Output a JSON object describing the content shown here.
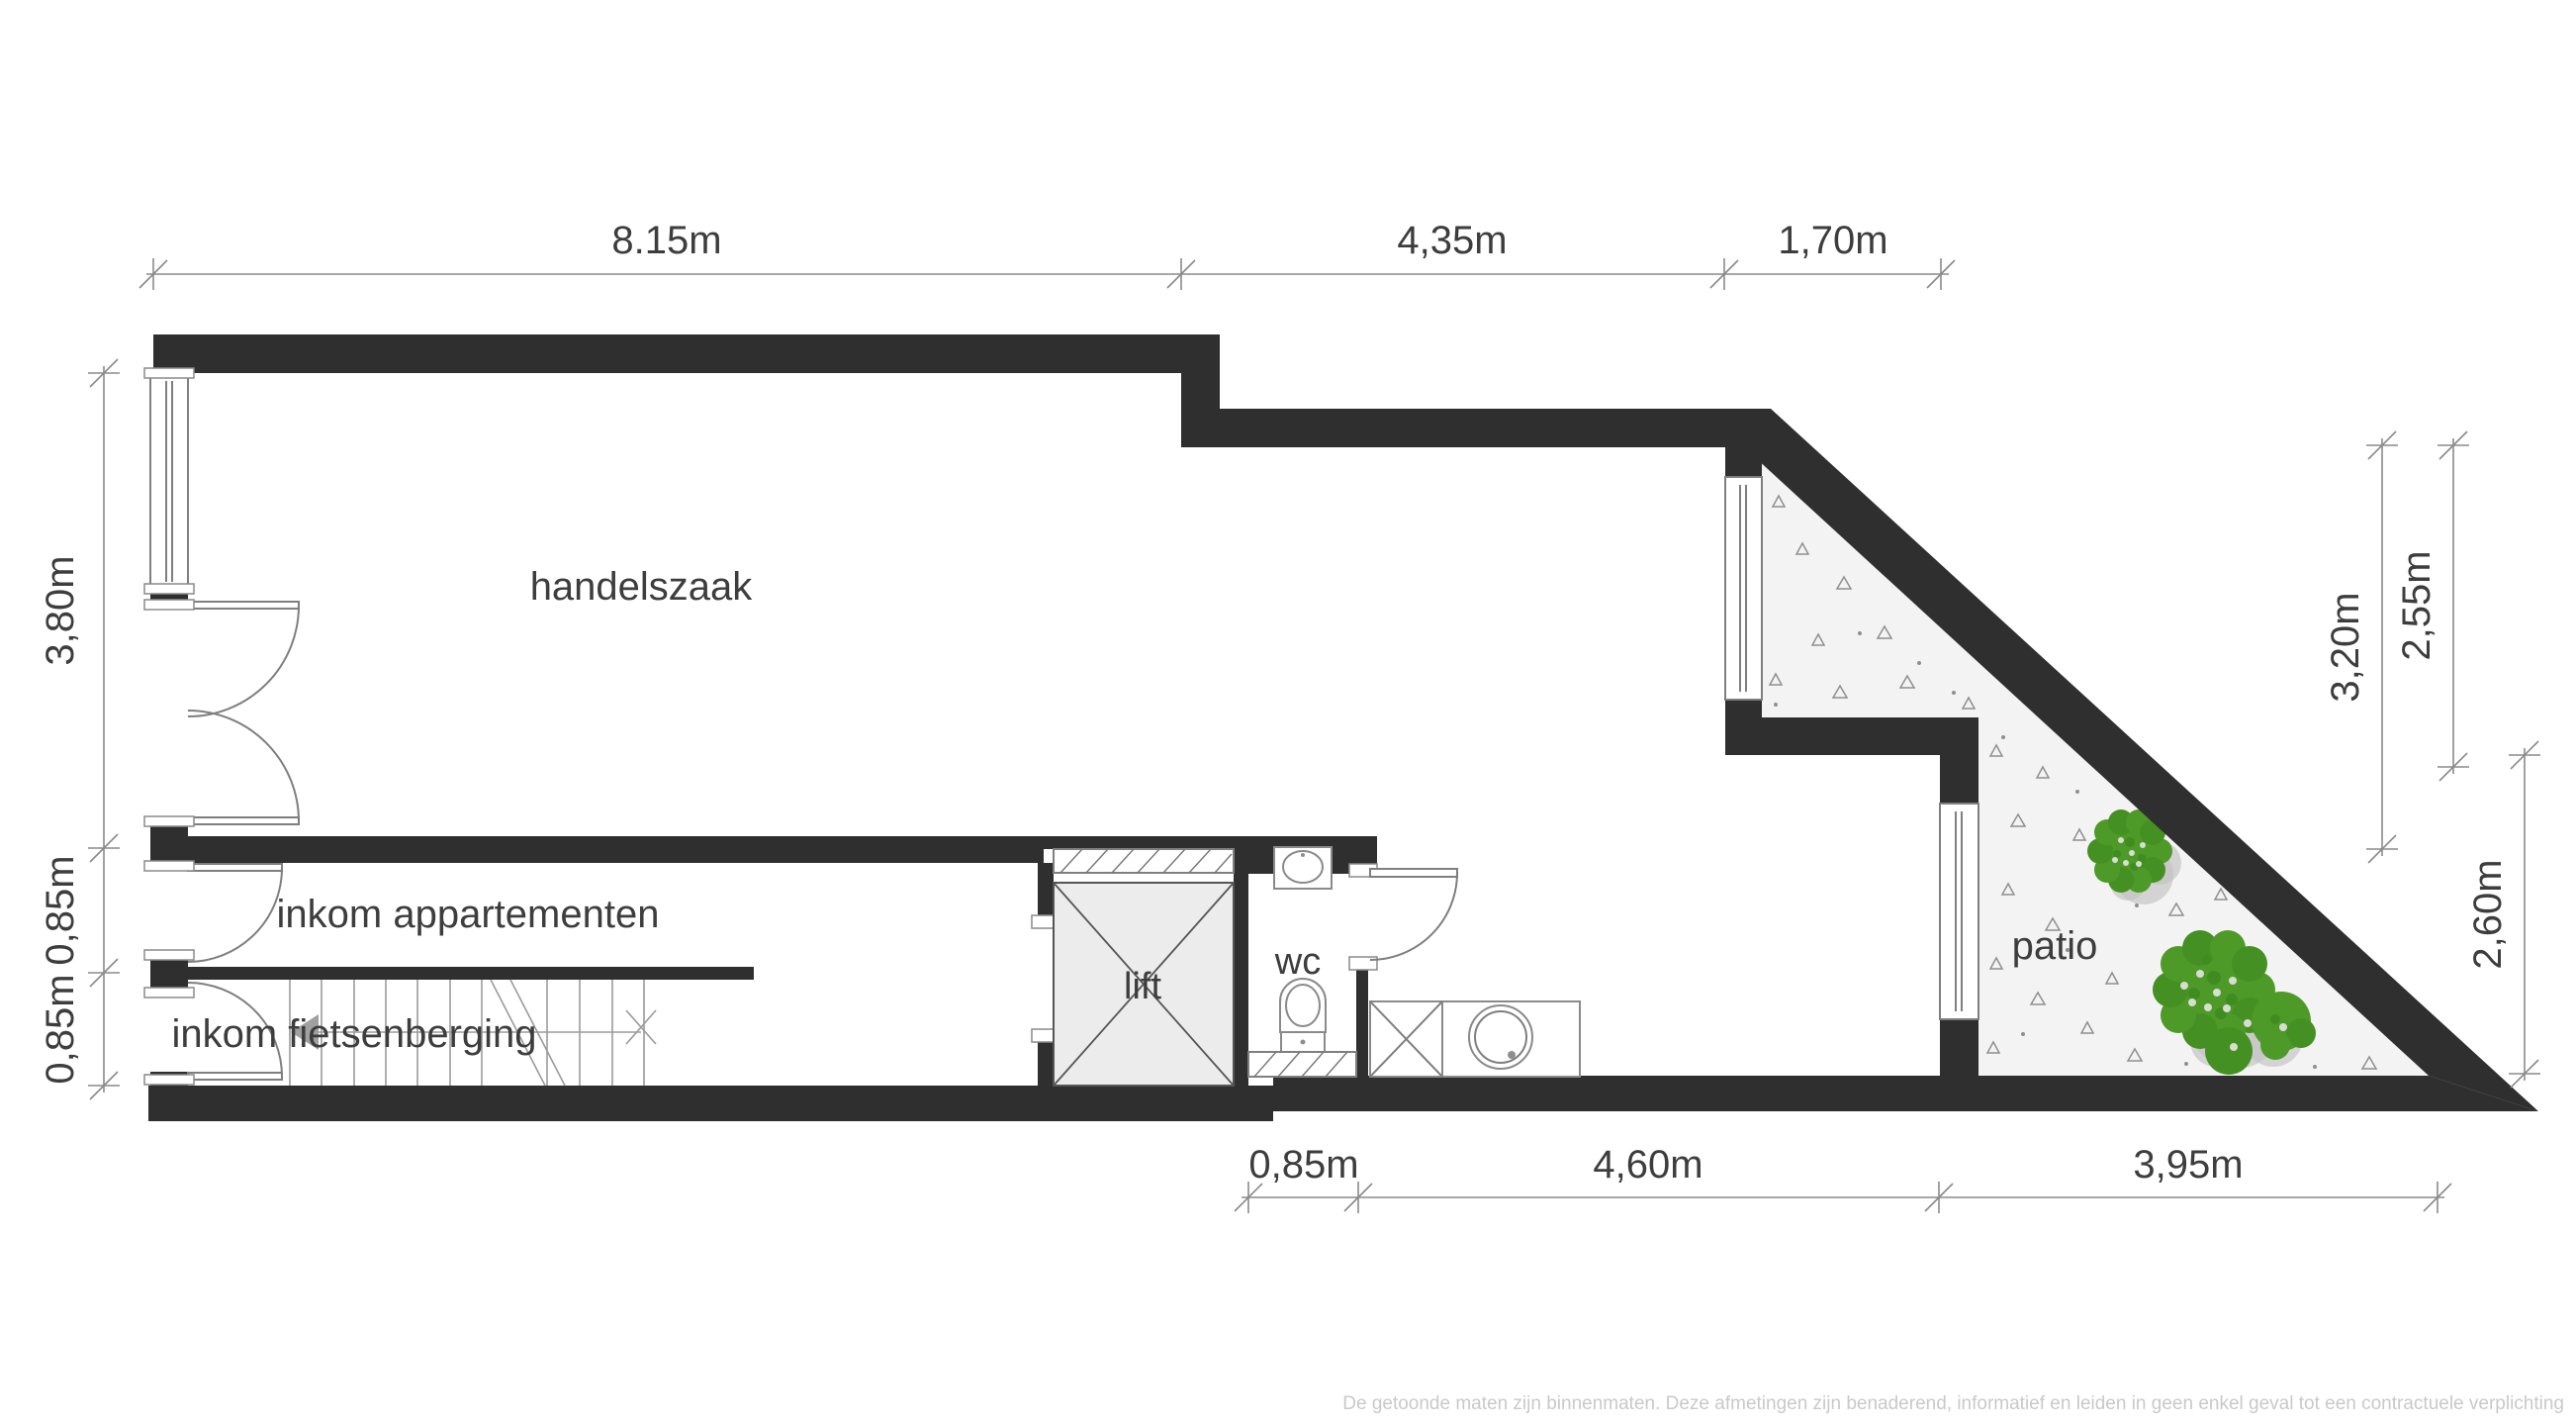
{
  "plan": {
    "rooms": {
      "handelszaak": "handelszaak",
      "inkom_appartementen": "inkom appartementen",
      "inkom_fietsenberging": "inkom fietsenberging",
      "lift": "lift",
      "wc": "wc",
      "patio": "patio"
    },
    "dims": {
      "top": [
        "8.15m",
        "4,35m",
        "1,70m"
      ],
      "left": [
        "3,80m",
        "0,85m",
        "0,85m"
      ],
      "right": [
        "3,20m",
        "2,55m",
        "2,60m"
      ],
      "bottom": [
        "0,85m",
        "4,60m",
        "3,95m"
      ]
    },
    "footer_disclaimer": "De getoonde maten zijn binnenmaten. Deze afmetingen zijn benaderend, informatief en leiden in geen enkel geval tot een contractuele verplichting",
    "colors": {
      "wall": "#2f2f2f",
      "dimension_lines": "#8a8a8a",
      "dimension_text": "#3d3d3d",
      "room_text": "#3d3d3d",
      "patio_fill": "#f3f3f3",
      "lift_fill": "#ececec",
      "tree_green": "#4e9a28",
      "tree_shadow": "#c2c2c2",
      "disclaimer_text": "#c9c9c9"
    }
  }
}
